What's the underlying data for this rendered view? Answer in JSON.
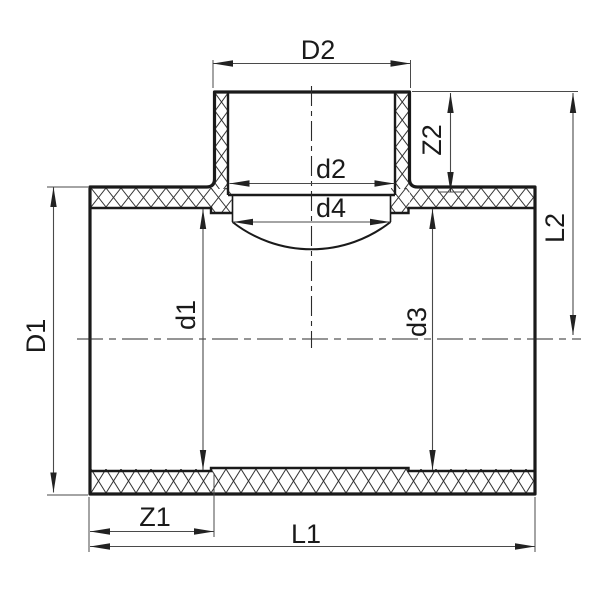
{
  "drawing": {
    "type": "technical-section-drawing",
    "subject": "pipe-tee-fitting-cross-section",
    "labels": {
      "D1": "D1",
      "D2": "D2",
      "d1": "d1",
      "d2": "d2",
      "d3": "d3",
      "d4": "d4",
      "L1": "L1",
      "L2": "L2",
      "Z1": "Z1",
      "Z2": "Z2"
    },
    "colors": {
      "outline": "#1a1a1a",
      "dimension_lines": "#4a4a4a",
      "hatch": "#333333",
      "background": "#ffffff"
    }
  }
}
